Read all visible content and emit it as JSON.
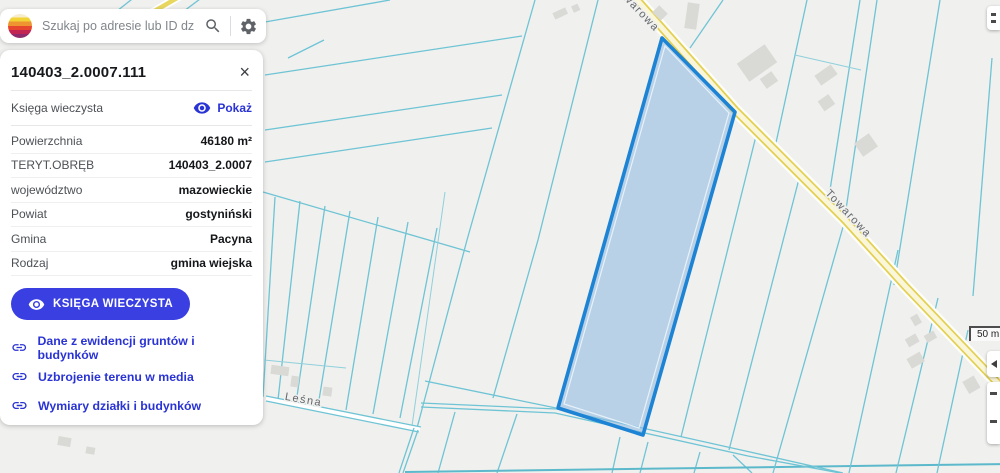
{
  "search": {
    "placeholder": "Szukaj po adresie lub ID działki ...",
    "logo_icon": "striped-globe",
    "search_icon": "magnifier",
    "settings_icon": "gear"
  },
  "panel": {
    "title": "140403_2.0007.111",
    "close_icon": "×",
    "kw_row": {
      "label": "Księga wieczysta",
      "action": "Pokaż",
      "icon": "eye"
    },
    "rows": [
      {
        "label": "Powierzchnia",
        "value": "46180 m²"
      },
      {
        "label": "TERYT.OBRĘB",
        "value": "140403_2.0007"
      },
      {
        "label": "województwo",
        "value": "mazowieckie"
      },
      {
        "label": "Powiat",
        "value": "gostyniński"
      },
      {
        "label": "Gmina",
        "value": "Pacyna"
      },
      {
        "label": "Rodzaj",
        "value": "gmina wiejska"
      }
    ],
    "kw_button": "KSIĘGA WIECZYSTA",
    "links": [
      {
        "label": "Dane z ewidencji gruntów i budynków",
        "icon": "link"
      },
      {
        "label": "Uzbrojenie terenu w media",
        "icon": "link"
      },
      {
        "label": "Wymiary działki i budynków",
        "icon": "link"
      }
    ]
  },
  "map": {
    "selected_parcel": "140403_2.0007.111",
    "street_labels": [
      {
        "text": "Towarowa"
      },
      {
        "text": "Towarowa"
      },
      {
        "text": "Leśna"
      }
    ],
    "scale_label": "50 m",
    "colors": {
      "parcel_outline": "#1d83d4",
      "parcel_fill": "#9cc4e6",
      "cadastral_line": "#6ec4d5",
      "road_fill": "#e3d052",
      "accent_blue": "#3a3fe2",
      "map_background": "#f0f0ee"
    }
  }
}
